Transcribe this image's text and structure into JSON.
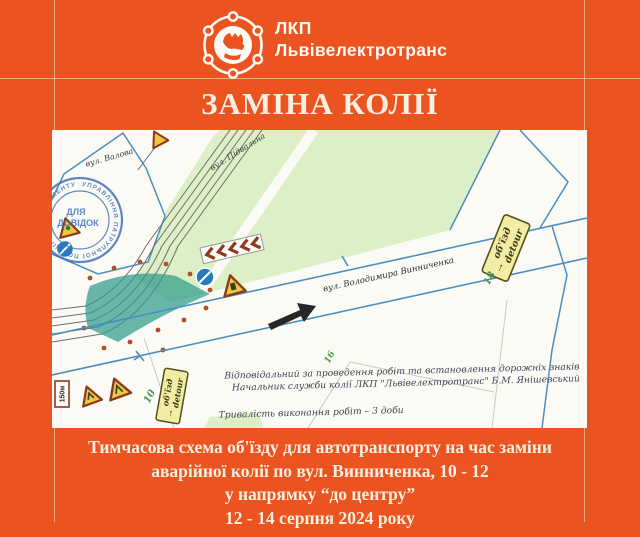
{
  "header": {
    "abbr": "ЛКП",
    "name": "Львівелектротранс"
  },
  "title": "ЗАМІНА КОЛІЇ",
  "map": {
    "streets": {
      "valova": "вул. Валова",
      "pidvalna": "вул. Підвальна",
      "vynnychenka": "вул. Володимира Винниченка"
    },
    "numbers": {
      "n10": "10",
      "n16": "16",
      "n18": "18"
    },
    "detour": {
      "arrow": "→",
      "ua": "об'їзд",
      "en": "detour"
    },
    "distance_sign": "150м",
    "stamp": {
      "ring": "УПРАВЛІННЯ ПАТРУЛЬНОЇ ПОЛІЦІЇ • ДЕПАРТАМЕНТУ ПАТРУЛЬНОЇ ПОЛІЦІЇ У",
      "line1": "ДЛЯ",
      "line2": "ДОВІДОК"
    },
    "notes": [
      "Відповідальний за проведення робіт та встановлення дорожніх знаків",
      "Начальник служби колії ЛКП \"Львівелектротранс\" Б.М. Янішевський",
      "Тривалість виконання робіт – 3 доби"
    ]
  },
  "caption": {
    "lines": [
      "Тимчасова схема об'їзду для автотранспорту на час заміни",
      "аварійної колії по вул. Винниченка, 10 - 12",
      "у напрямку “до центру”",
      "12 - 14 серпня 2024 року"
    ]
  },
  "colors": {
    "accent": "#EB5321",
    "cream": "#F8EFDF",
    "map_blue": "#4A8FC0",
    "track_gray": "#70706A",
    "work_zone": "#2F9A8C",
    "dot_red": "#B0512B",
    "stamp_blue": "#3D6DB8",
    "sign_yellow": "#F2ECA4",
    "park_green": "#DCEFC6"
  }
}
